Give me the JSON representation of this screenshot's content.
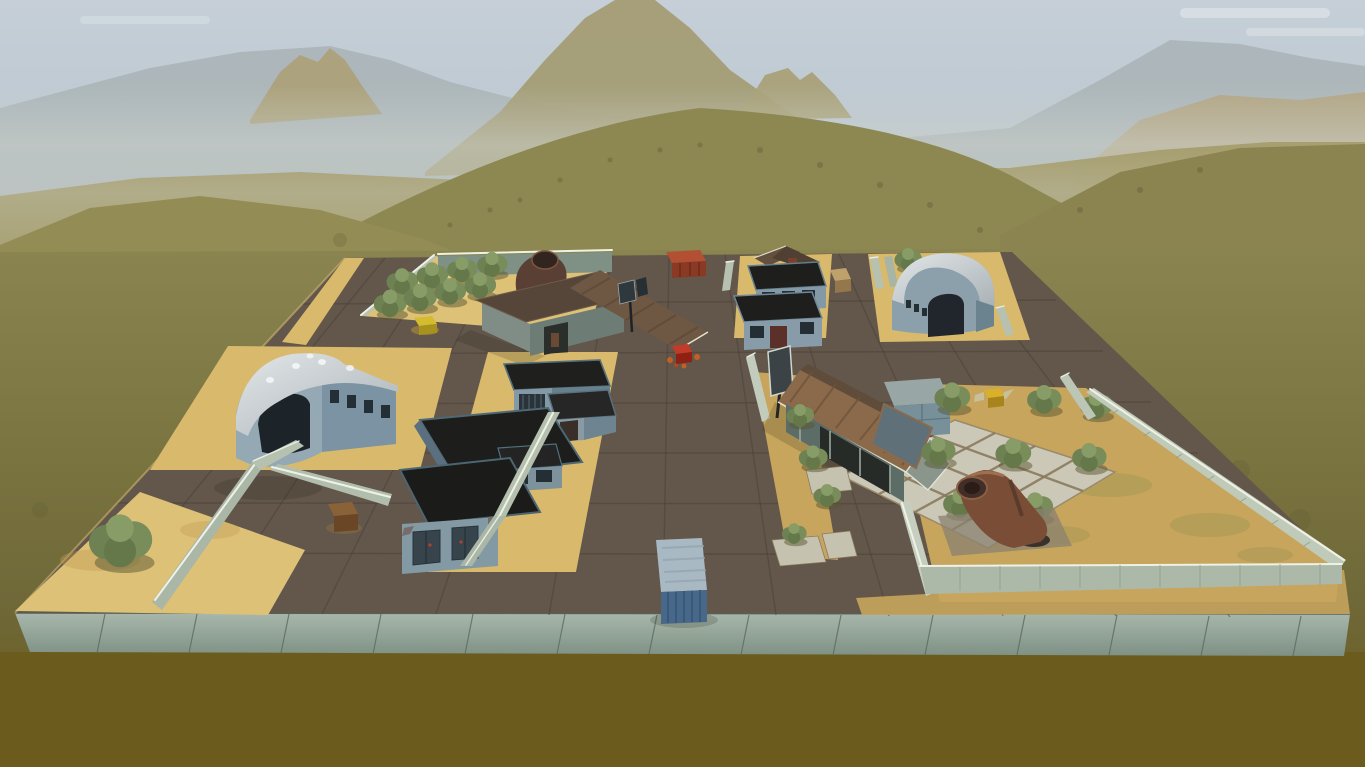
{
  "meta": {
    "app": "tank-game-3d-viewport",
    "scene": "desert-military-base-map",
    "view": "aerial-overview",
    "visible_text": "none"
  },
  "palette": {
    "sky": "#c2ccd6",
    "cloud": "#e8edf0",
    "mountainFar": "#a7b1b4",
    "mountainTan": "#a39b72",
    "outcropTan": "#aca077",
    "twinPeakTan": "#a79e74",
    "rockRight": "#b3a37e",
    "hillFar": "#a59d6d",
    "hillDome": "#8d8852",
    "hillLeft": "#938c55",
    "hillRight": "#8b8451",
    "groundDark": "#6b5c1d",
    "road": "#63564a",
    "sand": "#d9ba6c",
    "sandLight": "#ddc177",
    "sandYard": "#c7a55c",
    "edgeBlock": "#93a597",
    "wallLight": "#b6c1b0",
    "wallShade": "#7e9184",
    "fenceFace": "#c0cab9",
    "fenceFront": "#adb9a8",
    "buildingWall": "#8399a5",
    "buildingWallShade": "#65808c",
    "roofBlack": "#1f1f1e",
    "roofSilver": "#ccd2d6",
    "roofRust": "#8a6a4b",
    "roofBarn": "#6e5844",
    "barnWall": "#7f8d86",
    "houseWall": "#5c6c66",
    "containerRedTop": "#b35034",
    "containerRedFront": "#8a3a24",
    "containerBlueTop": "#a9b9c3",
    "containerBlueFront": "#48688a",
    "bush": "#788d5a",
    "pipeRust": "#7a4e36",
    "tile": "#ccc8b7",
    "crateYellow": "#d4bc2e",
    "crateGold": "#d8b02a",
    "crateTan": "#bfa26b",
    "crateRust": "#8a6238",
    "bonusRed": "#c23b28"
  },
  "counts": {
    "orchard_bushes": 8,
    "yard_bushes": 9,
    "standalone_trees": 2,
    "containers": 2,
    "hangars": 2
  },
  "objects": [
    {
      "name": "sky",
      "label": "hazy pale sky"
    },
    {
      "name": "far-mountains",
      "label": "distant blue-grey mountain ridge"
    },
    {
      "name": "central-peak",
      "label": "tall tan mountain massif"
    },
    {
      "name": "rolling-hills",
      "label": "olive grassland hills"
    },
    {
      "name": "map-platform",
      "label": "raised rectangular base platform with concrete block edge"
    },
    {
      "name": "road-grid",
      "label": "dark asphalt plate roads"
    },
    {
      "name": "orchard",
      "label": "walled orchard with bush rows"
    },
    {
      "name": "barn",
      "label": "barn with brown pitched roof and vent pipe"
    },
    {
      "name": "north-office-buildings",
      "label": "two flat-roof blue buildings and pitched-roof house"
    },
    {
      "name": "north-hangar",
      "label": "quonset hangar, curved silver roof"
    },
    {
      "name": "west-hangar",
      "label": "large quonset hangar, curved silver roof"
    },
    {
      "name": "west-warehouses",
      "label": "flat black-roof warehouse cluster"
    },
    {
      "name": "rusty-roof-house",
      "label": "long house with corrugated rust roof"
    },
    {
      "name": "tile-pad",
      "label": "concrete tile pad grid"
    },
    {
      "name": "yard-pipe",
      "label": "large rusty pipe elbow in ground"
    },
    {
      "name": "container-red",
      "label": "red cargo container"
    },
    {
      "name": "container-blue",
      "label": "blue cargo container"
    },
    {
      "name": "bonus-crate",
      "label": "red supply crate on road"
    },
    {
      "name": "billboard",
      "label": "sign panel on pole"
    },
    {
      "name": "sign-pole",
      "label": "small double sign pole"
    },
    {
      "name": "crate-yellow",
      "label": "yellow crate in orchard"
    },
    {
      "name": "crate-gold",
      "label": "gold crate in yard"
    },
    {
      "name": "crate-tan",
      "label": "wooden crate on road"
    },
    {
      "name": "crate-rust",
      "label": "rusty crate on sand"
    },
    {
      "name": "tree-southwest",
      "label": "bushy tree at sand corner"
    },
    {
      "name": "tree-north",
      "label": "small tree behind wall"
    },
    {
      "name": "perimeter-fences",
      "label": "concrete panel fences with white caps"
    }
  ]
}
